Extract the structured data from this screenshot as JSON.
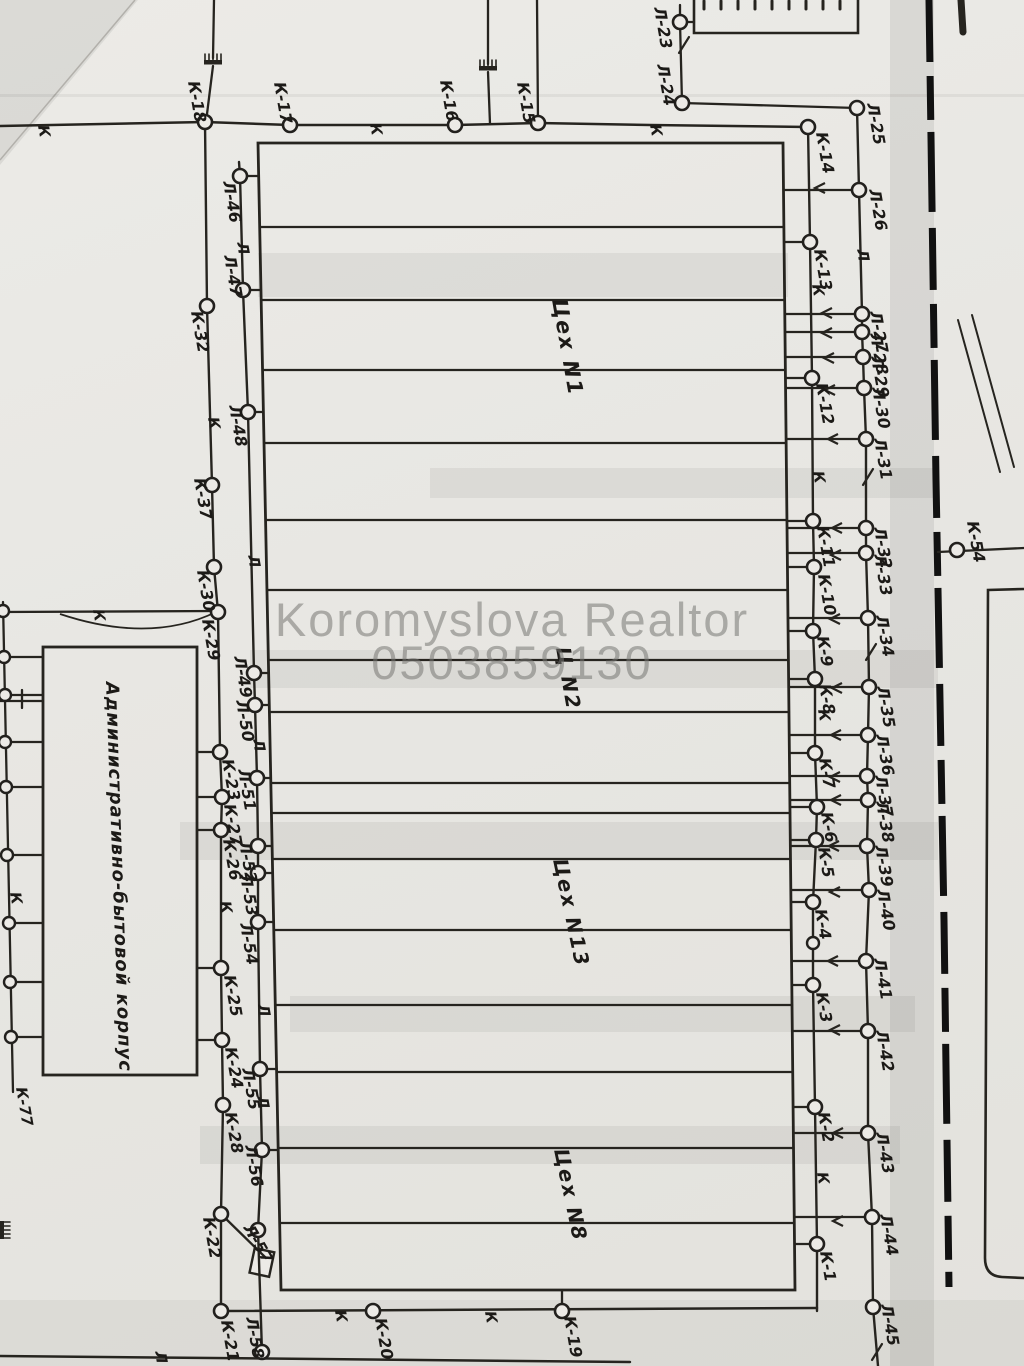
{
  "watermark": {
    "line1": "Koromyslova Realtor",
    "line2": "0503859130"
  },
  "colors": {
    "paper": "#e8e7e3",
    "ink": "#26241f",
    "watermark": "rgba(118,118,115,0.55)"
  },
  "buildings": {
    "admin": {
      "label": "Административно-бытовой корпус"
    },
    "shops": [
      {
        "label": "Цех N1",
        "x": 552,
        "y": 300,
        "a": 80,
        "size": 21
      },
      {
        "label": "Ц N2",
        "x": 556,
        "y": 648,
        "a": 80,
        "size": 20
      },
      {
        "label": "Цех N13",
        "x": 553,
        "y": 860,
        "a": 78,
        "size": 20
      },
      {
        "label": "Цех N8",
        "x": 554,
        "y": 1150,
        "a": 78,
        "size": 20
      }
    ]
  },
  "network": {
    "nodes": [
      {
        "label": "К-18",
        "x": 205,
        "y": 122,
        "dx": -17,
        "dy": -40
      },
      {
        "label": "К-17",
        "x": 290,
        "y": 125,
        "dx": -16,
        "dy": -42
      },
      {
        "label": "К-16",
        "x": 455,
        "y": 125,
        "dx": -15,
        "dy": -44
      },
      {
        "label": "К-15",
        "x": 538,
        "y": 123,
        "dx": -21,
        "dy": -40
      },
      {
        "label": "К-14",
        "x": 808,
        "y": 127,
        "dx": 8,
        "dy": 6
      },
      {
        "label": "К-32",
        "x": 207,
        "y": 306,
        "dx": -16,
        "dy": 6
      },
      {
        "label": "К-37",
        "x": 212,
        "y": 485,
        "dx": -18,
        "dy": -6
      },
      {
        "label": "К-30",
        "x": 214,
        "y": 567,
        "dx": -17,
        "dy": 4
      },
      {
        "label": "К-29",
        "x": 218,
        "y": 612,
        "dx": -16,
        "dy": 8
      },
      {
        "label": "К-23",
        "x": 220,
        "y": 752,
        "dx": 2,
        "dy": 8
      },
      {
        "label": "К-27",
        "x": 222,
        "y": 797,
        "dx": 2,
        "dy": 8
      },
      {
        "label": "К-26",
        "x": 221,
        "y": 830,
        "dx": 2,
        "dy": 10
      },
      {
        "label": "К-25",
        "x": 221,
        "y": 968,
        "dx": 3,
        "dy": 8
      },
      {
        "label": "К-24",
        "x": 222,
        "y": 1040,
        "dx": 3,
        "dy": 8
      },
      {
        "label": "К-28",
        "x": 223,
        "y": 1105,
        "dx": 2,
        "dy": 8
      },
      {
        "label": "К-22",
        "x": 221,
        "y": 1214,
        "dx": -18,
        "dy": 4
      },
      {
        "label": "К-21",
        "x": 221,
        "y": 1311,
        "dx": 0,
        "dy": 10
      },
      {
        "label": "Л-46",
        "x": 240,
        "y": 176,
        "dx": -17,
        "dy": 6
      },
      {
        "label": "Л-47",
        "x": 243,
        "y": 290,
        "dx": -19,
        "dy": -34
      },
      {
        "label": "Л-48",
        "x": 248,
        "y": 412,
        "dx": -19,
        "dy": -6
      },
      {
        "label": "Л-49",
        "x": 254,
        "y": 673,
        "dx": -20,
        "dy": -16
      },
      {
        "label": "Л-50",
        "x": 255,
        "y": 705,
        "dx": -19,
        "dy": -4
      },
      {
        "label": "Л-51",
        "x": 257,
        "y": 778,
        "dx": -19,
        "dy": -8
      },
      {
        "label": "Л-52",
        "x": 258,
        "y": 846,
        "dx": -19,
        "dy": -4
      },
      {
        "label": "Л-53",
        "x": 258,
        "y": 873,
        "dx": -18,
        "dy": 2
      },
      {
        "label": "Л-54",
        "x": 258,
        "y": 922,
        "dx": -18,
        "dy": 2
      },
      {
        "label": "Л-55",
        "x": 260,
        "y": 1069,
        "dx": -18,
        "dy": 0
      },
      {
        "label": "Л-56",
        "x": 262,
        "y": 1150,
        "dx": -17,
        "dy": -4
      },
      {
        "label": "Л-57",
        "x": 258,
        "y": 1230,
        "dx": -15,
        "dy": -2,
        "a": 60
      },
      {
        "label": "Л-58",
        "x": 262,
        "y": 1352,
        "dx": -16,
        "dy": -34
      },
      {
        "label": "Л-23",
        "x": 680,
        "y": 22,
        "dx": -26,
        "dy": -14
      },
      {
        "label": "Л-24",
        "x": 682,
        "y": 103,
        "dx": -25,
        "dy": -38
      },
      {
        "label": "Л-25",
        "x": 857,
        "y": 108,
        "dx": 10,
        "dy": -4
      },
      {
        "label": "Л-26",
        "x": 859,
        "y": 190,
        "dx": 10,
        "dy": 0
      },
      {
        "label": "Л-27",
        "x": 862,
        "y": 314,
        "dx": 8,
        "dy": -2
      },
      {
        "label": "Л-28",
        "x": 862,
        "y": 332,
        "dx": 8,
        "dy": 2
      },
      {
        "label": "Л-29",
        "x": 863,
        "y": 357,
        "dx": 8,
        "dy": 0
      },
      {
        "label": "Л-30",
        "x": 864,
        "y": 388,
        "dx": 8,
        "dy": 0
      },
      {
        "label": "Л-31",
        "x": 866,
        "y": 439,
        "dx": 8,
        "dy": 0
      },
      {
        "label": "Л-32",
        "x": 866,
        "y": 528,
        "dx": 8,
        "dy": 0
      },
      {
        "label": "Л-33",
        "x": 866,
        "y": 553,
        "dx": 8,
        "dy": 2
      },
      {
        "label": "Л-34",
        "x": 868,
        "y": 618,
        "dx": 8,
        "dy": -2
      },
      {
        "label": "Л-35",
        "x": 869,
        "y": 687,
        "dx": 8,
        "dy": 0
      },
      {
        "label": "Л-36",
        "x": 868,
        "y": 735,
        "dx": 8,
        "dy": 0
      },
      {
        "label": "Л-37",
        "x": 867,
        "y": 776,
        "dx": 8,
        "dy": 0
      },
      {
        "label": "Л-38",
        "x": 868,
        "y": 800,
        "dx": 8,
        "dy": 2
      },
      {
        "label": "Л-39",
        "x": 867,
        "y": 846,
        "dx": 8,
        "dy": 0
      },
      {
        "label": "Л-40",
        "x": 869,
        "y": 890,
        "dx": 8,
        "dy": 0
      },
      {
        "label": "Л-41",
        "x": 866,
        "y": 961,
        "dx": 8,
        "dy": -2
      },
      {
        "label": "Л-42",
        "x": 868,
        "y": 1031,
        "dx": 8,
        "dy": 0
      },
      {
        "label": "Л-43",
        "x": 868,
        "y": 1133,
        "dx": 8,
        "dy": 0
      },
      {
        "label": "Л-44",
        "x": 872,
        "y": 1217,
        "dx": 8,
        "dy": -2
      },
      {
        "label": "Л-45",
        "x": 873,
        "y": 1307,
        "dx": 8,
        "dy": -2
      },
      {
        "label": "К-13",
        "x": 810,
        "y": 242,
        "dx": 4,
        "dy": 8
      },
      {
        "label": "К-12",
        "x": 812,
        "y": 378,
        "dx": 4,
        "dy": 6
      },
      {
        "label": "К-11",
        "x": 813,
        "y": 521,
        "dx": 4,
        "dy": 6
      },
      {
        "label": "К-10",
        "x": 814,
        "y": 567,
        "dx": 4,
        "dy": 8
      },
      {
        "label": "К-9",
        "x": 813,
        "y": 631,
        "dx": 4,
        "dy": 6
      },
      {
        "label": "К-8",
        "x": 815,
        "y": 679,
        "dx": 4,
        "dy": 6
      },
      {
        "label": "К-7",
        "x": 815,
        "y": 753,
        "dx": 4,
        "dy": 6
      },
      {
        "label": "К-6",
        "x": 817,
        "y": 807,
        "dx": 4,
        "dy": 6
      },
      {
        "label": "К-5",
        "x": 816,
        "y": 840,
        "dx": 2,
        "dy": 8
      },
      {
        "label": "К-4",
        "x": 813,
        "y": 902,
        "dx": 2,
        "dy": 8
      },
      {
        "label": "К-3",
        "x": 813,
        "y": 985,
        "dx": 3,
        "dy": 8
      },
      {
        "label": "К-2",
        "x": 815,
        "y": 1107,
        "dx": 3,
        "dy": 6
      },
      {
        "label": "К-1",
        "x": 817,
        "y": 1244,
        "dx": 3,
        "dy": 8
      },
      {
        "label": "К-20",
        "x": 373,
        "y": 1311,
        "dx": 2,
        "dy": 8
      },
      {
        "label": "К-19",
        "x": 562,
        "y": 1311,
        "dx": 2,
        "dy": 6
      },
      {
        "label": "К-54",
        "x": 957,
        "y": 550,
        "dx": 10,
        "dy": -28
      }
    ],
    "plain_nodes": [
      [
        3,
        611
      ],
      [
        4,
        657
      ],
      [
        5,
        695
      ],
      [
        5,
        742
      ],
      [
        6,
        787
      ],
      [
        7,
        855
      ],
      [
        9,
        923
      ],
      [
        10,
        982
      ],
      [
        11,
        1037
      ],
      [
        813,
        943
      ]
    ],
    "markers": [
      {
        "t": "К",
        "x": 38,
        "y": 126
      },
      {
        "t": "К",
        "x": 370,
        "y": 124
      },
      {
        "t": "К",
        "x": 650,
        "y": 125
      },
      {
        "t": "К",
        "x": 93,
        "y": 610
      },
      {
        "t": "К",
        "x": 208,
        "y": 418
      },
      {
        "t": "К",
        "x": 220,
        "y": 902
      },
      {
        "t": "К",
        "x": 10,
        "y": 893
      },
      {
        "t": "К",
        "x": 812,
        "y": 285
      },
      {
        "t": "К",
        "x": 813,
        "y": 472
      },
      {
        "t": "К",
        "x": 818,
        "y": 710
      },
      {
        "t": "К",
        "x": 817,
        "y": 1173
      },
      {
        "t": "К",
        "x": 335,
        "y": 1311
      },
      {
        "t": "К",
        "x": 485,
        "y": 1312
      },
      {
        "t": "Л",
        "x": 237,
        "y": 243
      },
      {
        "t": "Л",
        "x": 248,
        "y": 556
      },
      {
        "t": "Л",
        "x": 253,
        "y": 740
      },
      {
        "t": "Л",
        "x": 258,
        "y": 1005
      },
      {
        "t": "Л",
        "x": 257,
        "y": 1097
      },
      {
        "t": "Л",
        "x": 155,
        "y": 1352
      },
      {
        "t": "Л",
        "x": 857,
        "y": 250
      }
    ],
    "extra_labels": [
      {
        "label": "К-77",
        "x": 16,
        "y": 1088
      }
    ],
    "arrows": [
      [
        820,
        188
      ],
      [
        827,
        313
      ],
      [
        827,
        333
      ],
      [
        829,
        358
      ],
      [
        830,
        390
      ],
      [
        833,
        439
      ],
      [
        837,
        528
      ],
      [
        836,
        555
      ],
      [
        835,
        619
      ],
      [
        837,
        688
      ],
      [
        836,
        735
      ],
      [
        835,
        777
      ],
      [
        836,
        800
      ],
      [
        834,
        846
      ],
      [
        835,
        892
      ],
      [
        833,
        961
      ],
      [
        835,
        1030
      ],
      [
        838,
        1133
      ],
      [
        838,
        1221
      ]
    ],
    "slashes": [
      [
        684,
        45
      ],
      [
        868,
        477
      ],
      [
        871,
        652
      ],
      [
        877,
        1352
      ]
    ]
  }
}
